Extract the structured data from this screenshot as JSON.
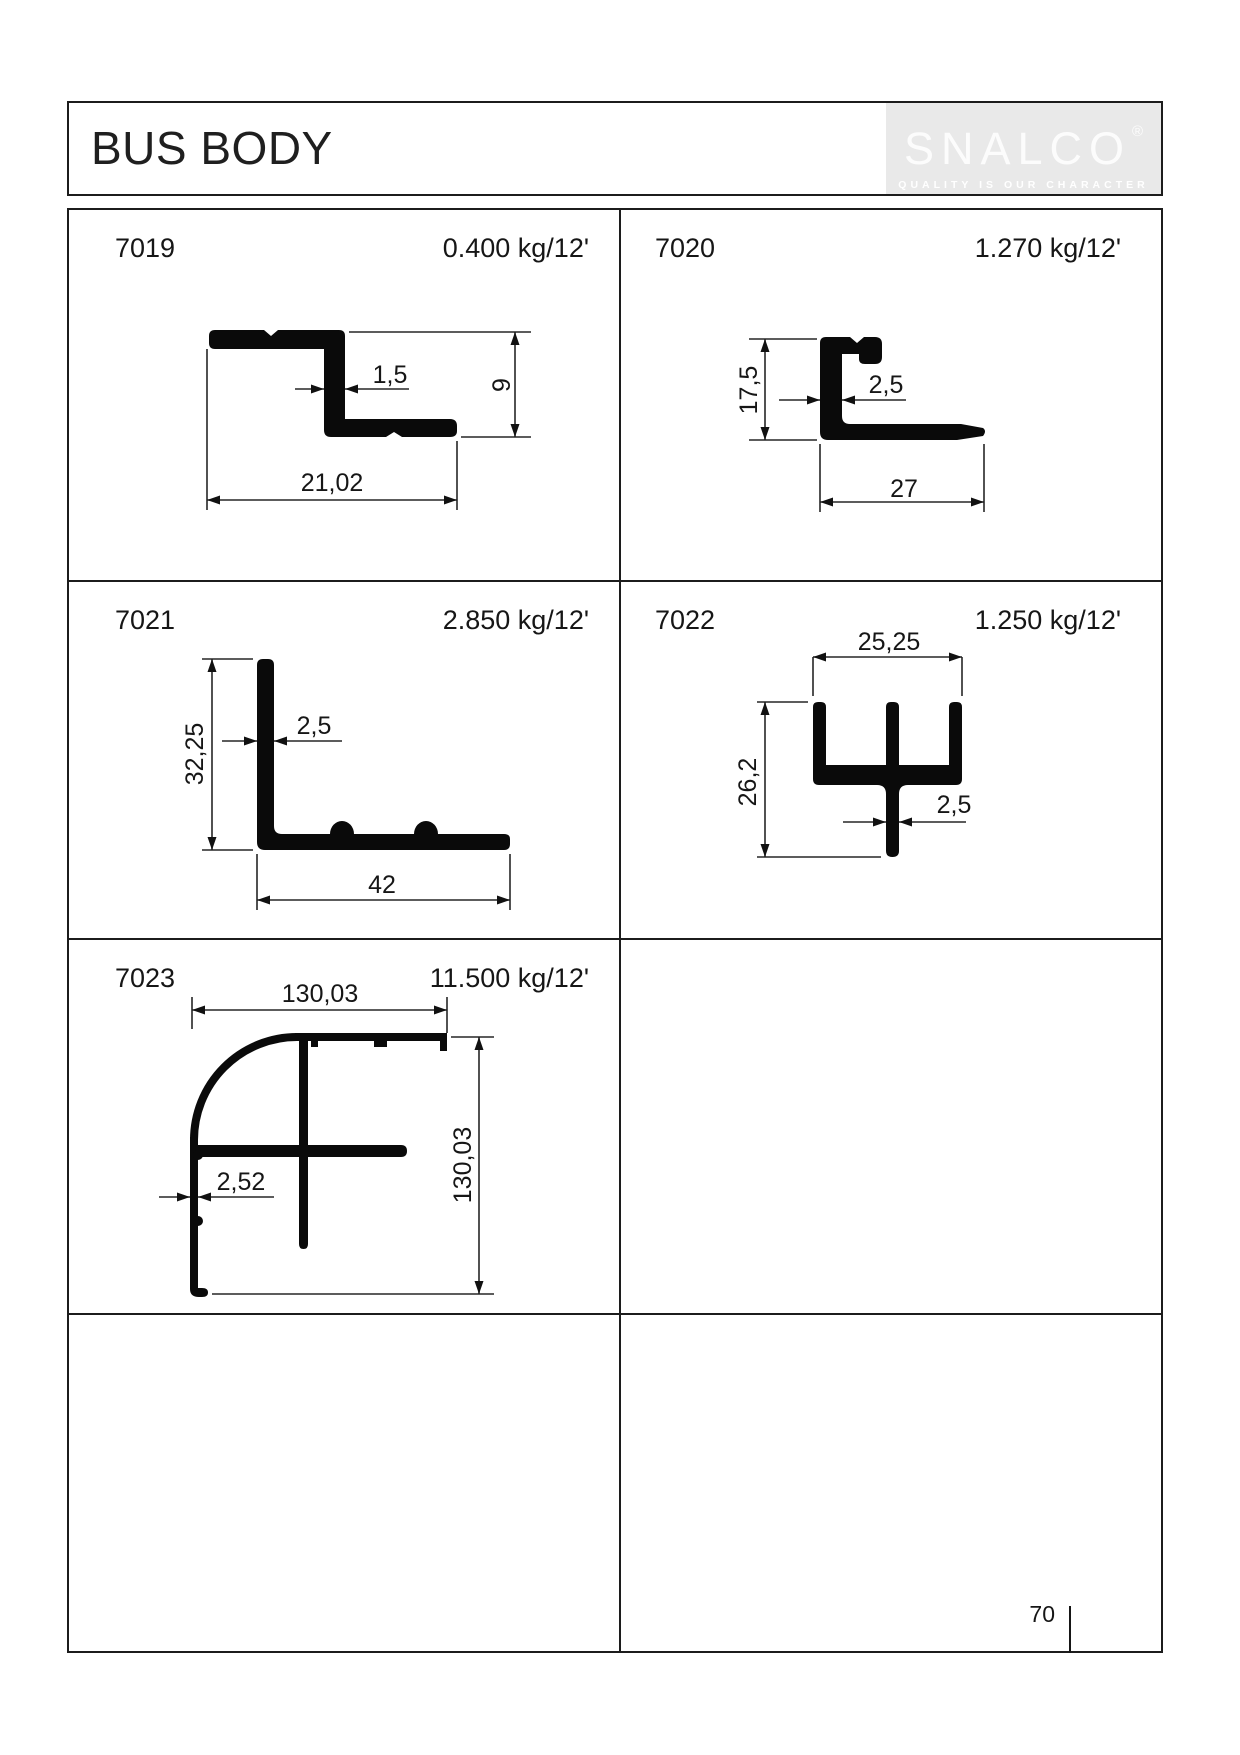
{
  "header": {
    "title": "BUS BODY",
    "logo": {
      "brand": "SNALCO",
      "registered": "®",
      "tagline": "QUALITY IS OUR CHARACTER"
    }
  },
  "footer": {
    "page_number": "70"
  },
  "colors": {
    "ink": "#1a1a1a",
    "logo_bg": "#e9e9e9",
    "logo_text": "#ffffff"
  },
  "profiles": [
    {
      "code": "7019",
      "weight": "0.400 kg/12'",
      "dims": {
        "thickness": "1,5",
        "height": "9",
        "width": "21,02"
      }
    },
    {
      "code": "7020",
      "weight": "1.270 kg/12'",
      "dims": {
        "height": "17,5",
        "thickness": "2,5",
        "width": "27"
      }
    },
    {
      "code": "7021",
      "weight": "2.850 kg/12'",
      "dims": {
        "height": "32,25",
        "thickness": "2,5",
        "width": "42"
      }
    },
    {
      "code": "7022",
      "weight": "1.250 kg/12'",
      "dims": {
        "top_width": "25,25",
        "height": "26,2",
        "thickness": "2,5"
      }
    },
    {
      "code": "7023",
      "weight": "11.500 kg/12'",
      "dims": {
        "top_width": "130,03",
        "thickness": "2,52",
        "height": "130,03"
      }
    }
  ]
}
